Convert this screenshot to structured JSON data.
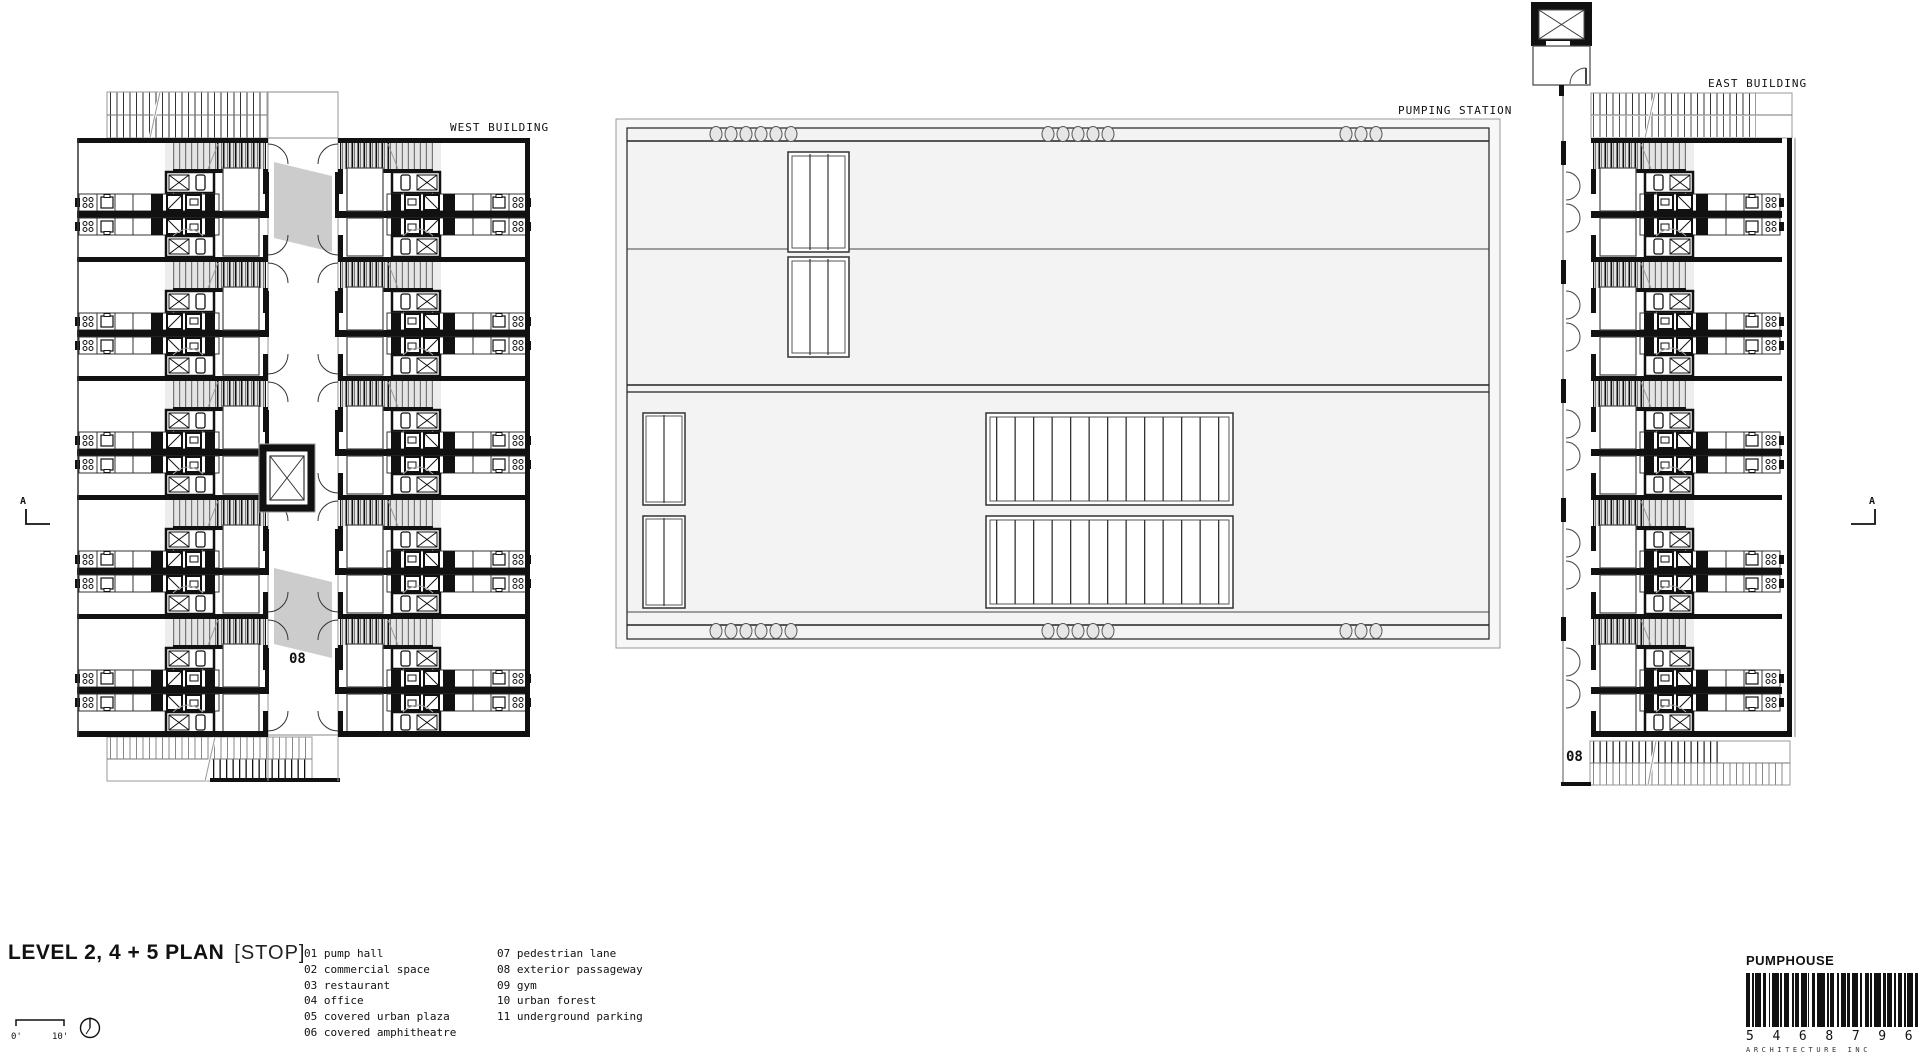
{
  "title": {
    "main": "LEVEL 2, 4 + 5 PLAN",
    "suffix": "[STOP]"
  },
  "scale_bar": {
    "zero": "0'",
    "ten": "10'"
  },
  "labels": {
    "west_building": "WEST BUILDING",
    "pumping_station": "PUMPING STATION",
    "east_building": "EAST BUILDING",
    "passage_west": "08",
    "passage_east": "08",
    "section_left": "A",
    "section_right": "A"
  },
  "legend": {
    "column1": [
      "01 pump hall",
      "02 commercial space",
      "03 restaurant",
      "04 office",
      "05 covered urban plaza",
      "06 covered amphitheatre"
    ],
    "column2": [
      "07 pedestrian lane",
      "08 exterior passageway",
      "09 gym",
      "10 urban forest",
      "11 underground parking"
    ]
  },
  "footer": {
    "firm": "PUMPHOUSE",
    "barcode_number": "5 4 6 8 7 9 6",
    "barcode_caption": "ARCHITECTURE INC"
  },
  "colors": {
    "ink": "#111111",
    "hatch_gray": "#999999",
    "plan_fill": "#f3f3f3",
    "shade": "#cccccc"
  }
}
